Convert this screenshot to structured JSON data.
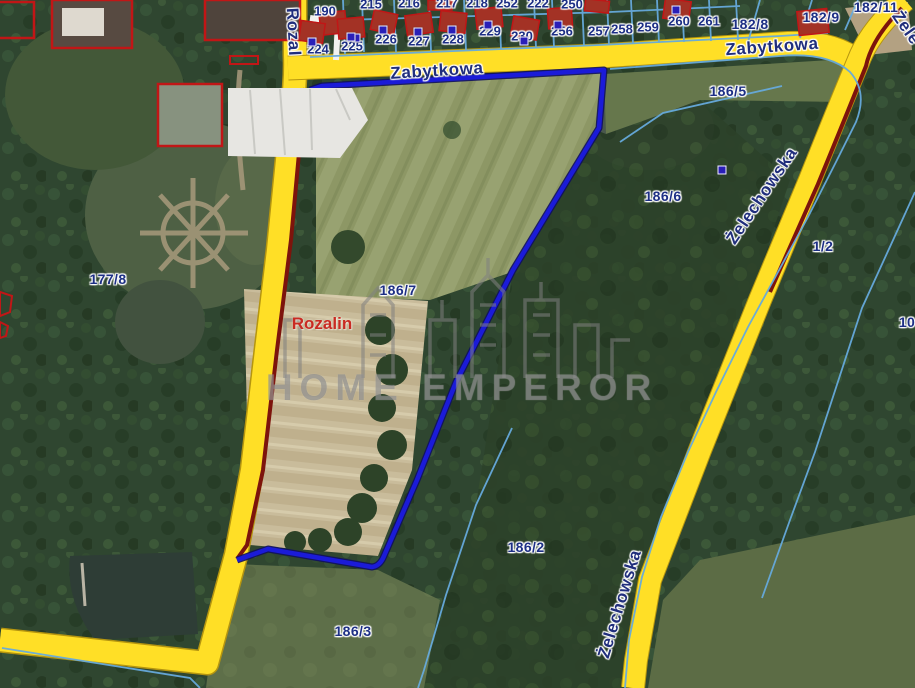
{
  "map": {
    "type_note": "cadastral satellite map",
    "watermark": {
      "text": "HOME EMPEROR",
      "logo": "skyline-buildings-icon"
    },
    "place_label": {
      "text": "Rozalin",
      "x": 322,
      "y": 324
    },
    "colors": {
      "road_yellow": "#ffdf26",
      "subject_parcel_blue": "#1b1bd8",
      "cadastral_cyan": "#66aadc",
      "boundary_maroon": "#7d140c",
      "building_red": "#c11616",
      "label_navy": "#1d2f85"
    },
    "street_labels": [
      {
        "name": "Zabytkowa",
        "x": 437,
        "y": 71,
        "rot": -3.5
      },
      {
        "name": "Zabytkowa",
        "x": 772,
        "y": 47,
        "rot": -4
      },
      {
        "name": "Żelechowska",
        "x": 762,
        "y": 196,
        "rot": -56
      },
      {
        "name": "Żelechowska",
        "x": 620,
        "y": 604,
        "rot": -73
      },
      {
        "name": "Rozal",
        "x": 293,
        "y": 32,
        "rot": 87
      },
      {
        "name": "Żele",
        "x": 906,
        "y": 28,
        "rot": 55
      }
    ],
    "parcel_labels": [
      {
        "text": "177/8",
        "x": 108,
        "y": 279
      },
      {
        "text": "186/7",
        "x": 398,
        "y": 290
      },
      {
        "text": "186/5",
        "x": 728,
        "y": 91
      },
      {
        "text": "186/6",
        "x": 663,
        "y": 196
      },
      {
        "text": "1/2",
        "x": 823,
        "y": 246
      },
      {
        "text": "186/2",
        "x": 526,
        "y": 547
      },
      {
        "text": "186/3",
        "x": 353,
        "y": 631
      },
      {
        "text": "10",
        "x": 907,
        "y": 322
      },
      {
        "text": "182/8",
        "x": 750,
        "y": 24
      },
      {
        "text": "182/9",
        "x": 821,
        "y": 17
      },
      {
        "text": "182/11",
        "x": 876,
        "y": 7
      }
    ],
    "house_numbers": [
      {
        "text": "190",
        "x": 325,
        "y": 11
      },
      {
        "text": "224",
        "x": 318,
        "y": 49
      },
      {
        "text": "225",
        "x": 352,
        "y": 46
      },
      {
        "text": "226",
        "x": 386,
        "y": 39
      },
      {
        "text": "227",
        "x": 419,
        "y": 41
      },
      {
        "text": "228",
        "x": 453,
        "y": 39
      },
      {
        "text": "229",
        "x": 490,
        "y": 31
      },
      {
        "text": "230",
        "x": 522,
        "y": 36
      },
      {
        "text": "256",
        "x": 562,
        "y": 31
      },
      {
        "text": "257",
        "x": 599,
        "y": 31
      },
      {
        "text": "258",
        "x": 622,
        "y": 29
      },
      {
        "text": "259",
        "x": 648,
        "y": 27
      },
      {
        "text": "260",
        "x": 679,
        "y": 21
      },
      {
        "text": "261",
        "x": 709,
        "y": 21
      },
      {
        "text": "215",
        "x": 371,
        "y": 4
      },
      {
        "text": "216",
        "x": 409,
        "y": 3
      },
      {
        "text": "217",
        "x": 447,
        "y": 3
      },
      {
        "text": "218",
        "x": 477,
        "y": 3
      },
      {
        "text": "252",
        "x": 507,
        "y": 3
      },
      {
        "text": "222",
        "x": 538,
        "y": 3
      },
      {
        "text": "250",
        "x": 572,
        "y": 4
      }
    ],
    "building_markers": [
      {
        "x": 356,
        "y": 38
      },
      {
        "x": 312,
        "y": 42
      },
      {
        "x": 351,
        "y": 37
      },
      {
        "x": 383,
        "y": 30
      },
      {
        "x": 418,
        "y": 32
      },
      {
        "x": 452,
        "y": 30
      },
      {
        "x": 488,
        "y": 25
      },
      {
        "x": 524,
        "y": 41
      },
      {
        "x": 558,
        "y": 25
      },
      {
        "x": 676,
        "y": 10
      },
      {
        "x": 722,
        "y": 170
      }
    ]
  }
}
